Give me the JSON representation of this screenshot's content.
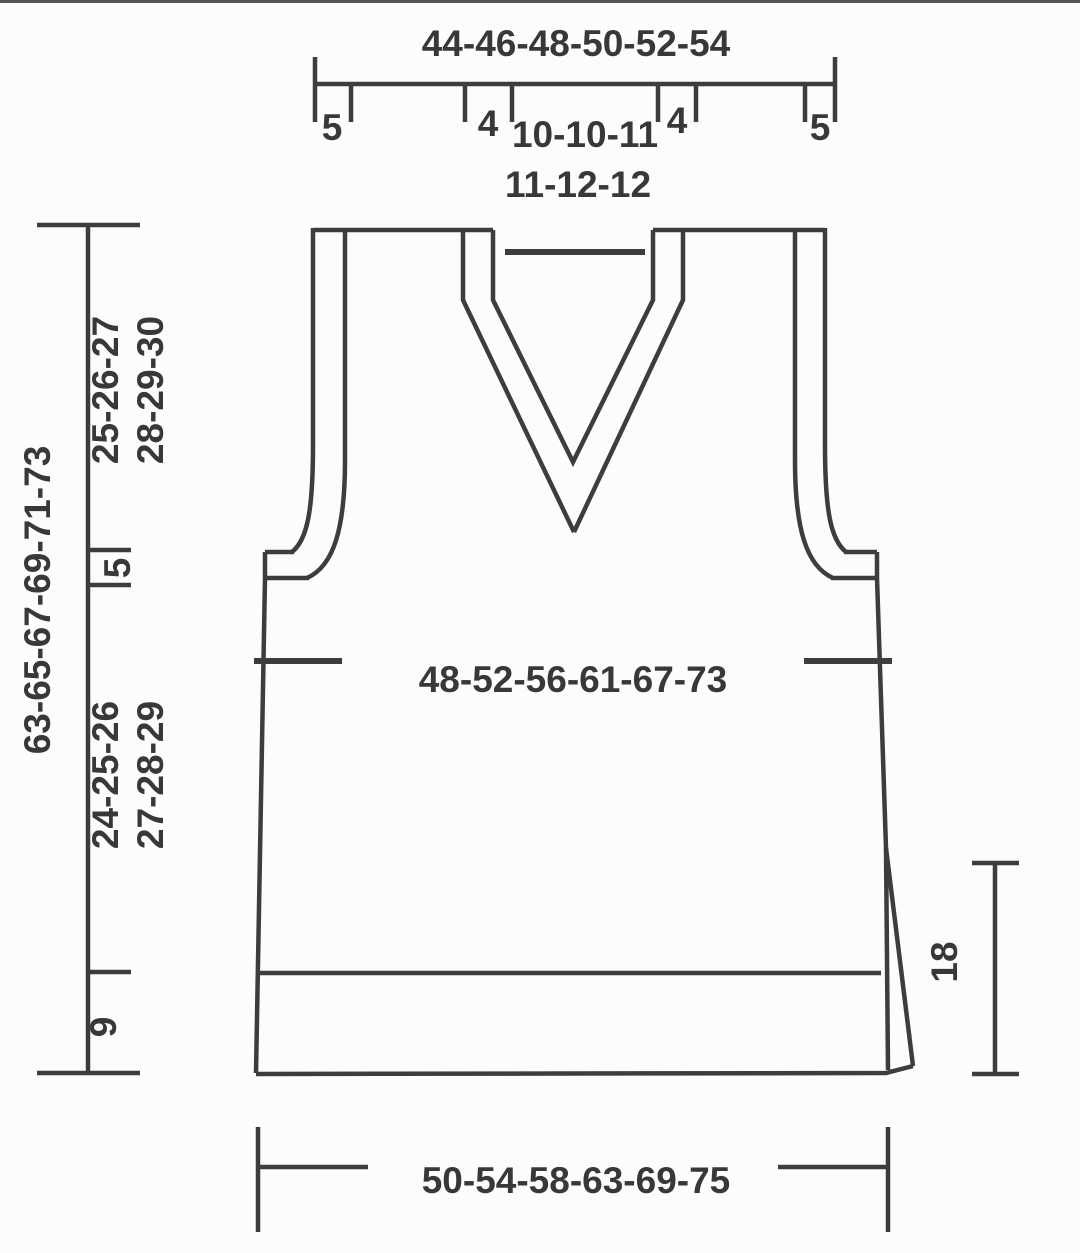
{
  "schematic": {
    "title_hint": "knitting-pattern-vest-schematic",
    "top_ruler": {
      "total_width_label": "44-46-48-50-52-54",
      "left_edge_label": "5",
      "left_shoulder_label": "4",
      "neck_width_line1": "10-10-11",
      "neck_width_line2": "11-12-12",
      "right_shoulder_label": "4",
      "right_edge_label": "5"
    },
    "left_ruler": {
      "total_length_label": "63-65-67-69-71-73",
      "upper_section_line1": "25-26-27",
      "upper_section_line2": "28-29-30",
      "armhole_band_label": "5",
      "lower_section_line1": "24-25-26",
      "lower_section_line2": "27-28-29",
      "hem_label": "9"
    },
    "right_ruler": {
      "slit_length_label": "18"
    },
    "body": {
      "chest_width_label": "48-52-56-61-67-73"
    },
    "bottom_ruler": {
      "hem_width_label": "50-54-58-63-69-75"
    },
    "colors": {
      "line": "#3d3d3d",
      "text": "#383838",
      "background": "#fcfcfc"
    }
  }
}
